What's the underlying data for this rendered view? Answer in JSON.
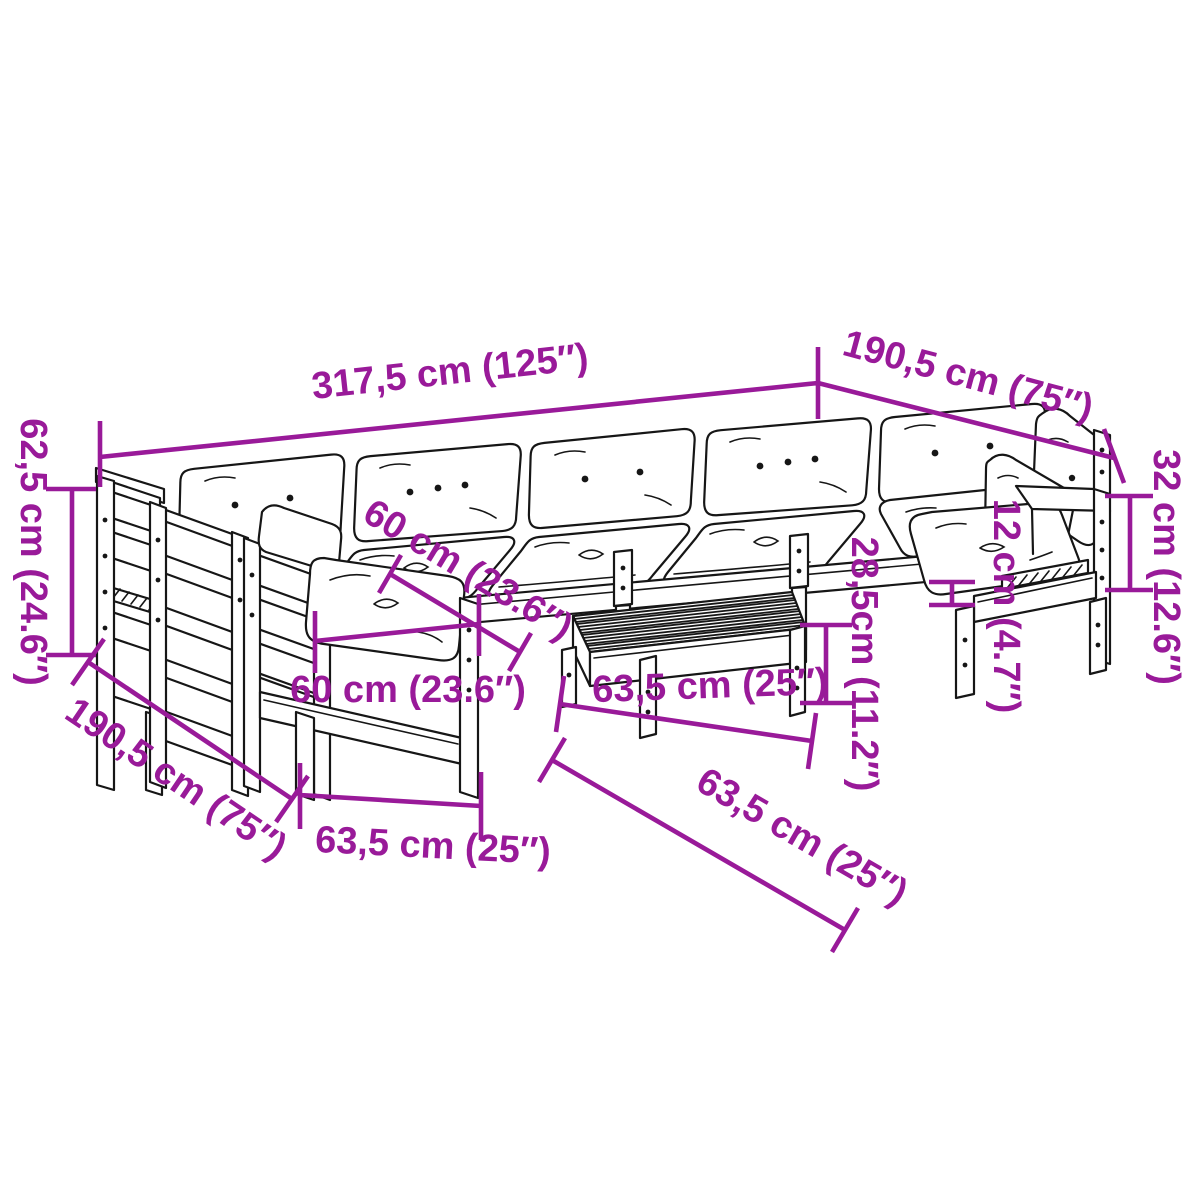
{
  "figure": {
    "kind": "product-dimension-diagram",
    "subject": "modular garden sofa set with cushions and slatted table"
  },
  "colors": {
    "dimension": "#991a99",
    "line_art": "#161616",
    "background": "#ffffff"
  },
  "dimensions": {
    "total_length": "317,5 cm (125″)",
    "right_depth": "190,5 cm (75″)",
    "left_depth": "190,5 cm (75″)",
    "back_height": "62,5 cm (24.6″)",
    "arm_height": "32 cm (12.6″)",
    "seat_width": "60 cm (23.6″)",
    "seat_depth": "60 cm (23.6″)",
    "module_width": "63,5 cm (25″)",
    "table_width": "63,5 cm (25″)",
    "table_depth": "63,5 cm (25″)",
    "table_height": "28,5cm (11.2″)",
    "cushion_thickness": "12 cm (4.7″)"
  }
}
